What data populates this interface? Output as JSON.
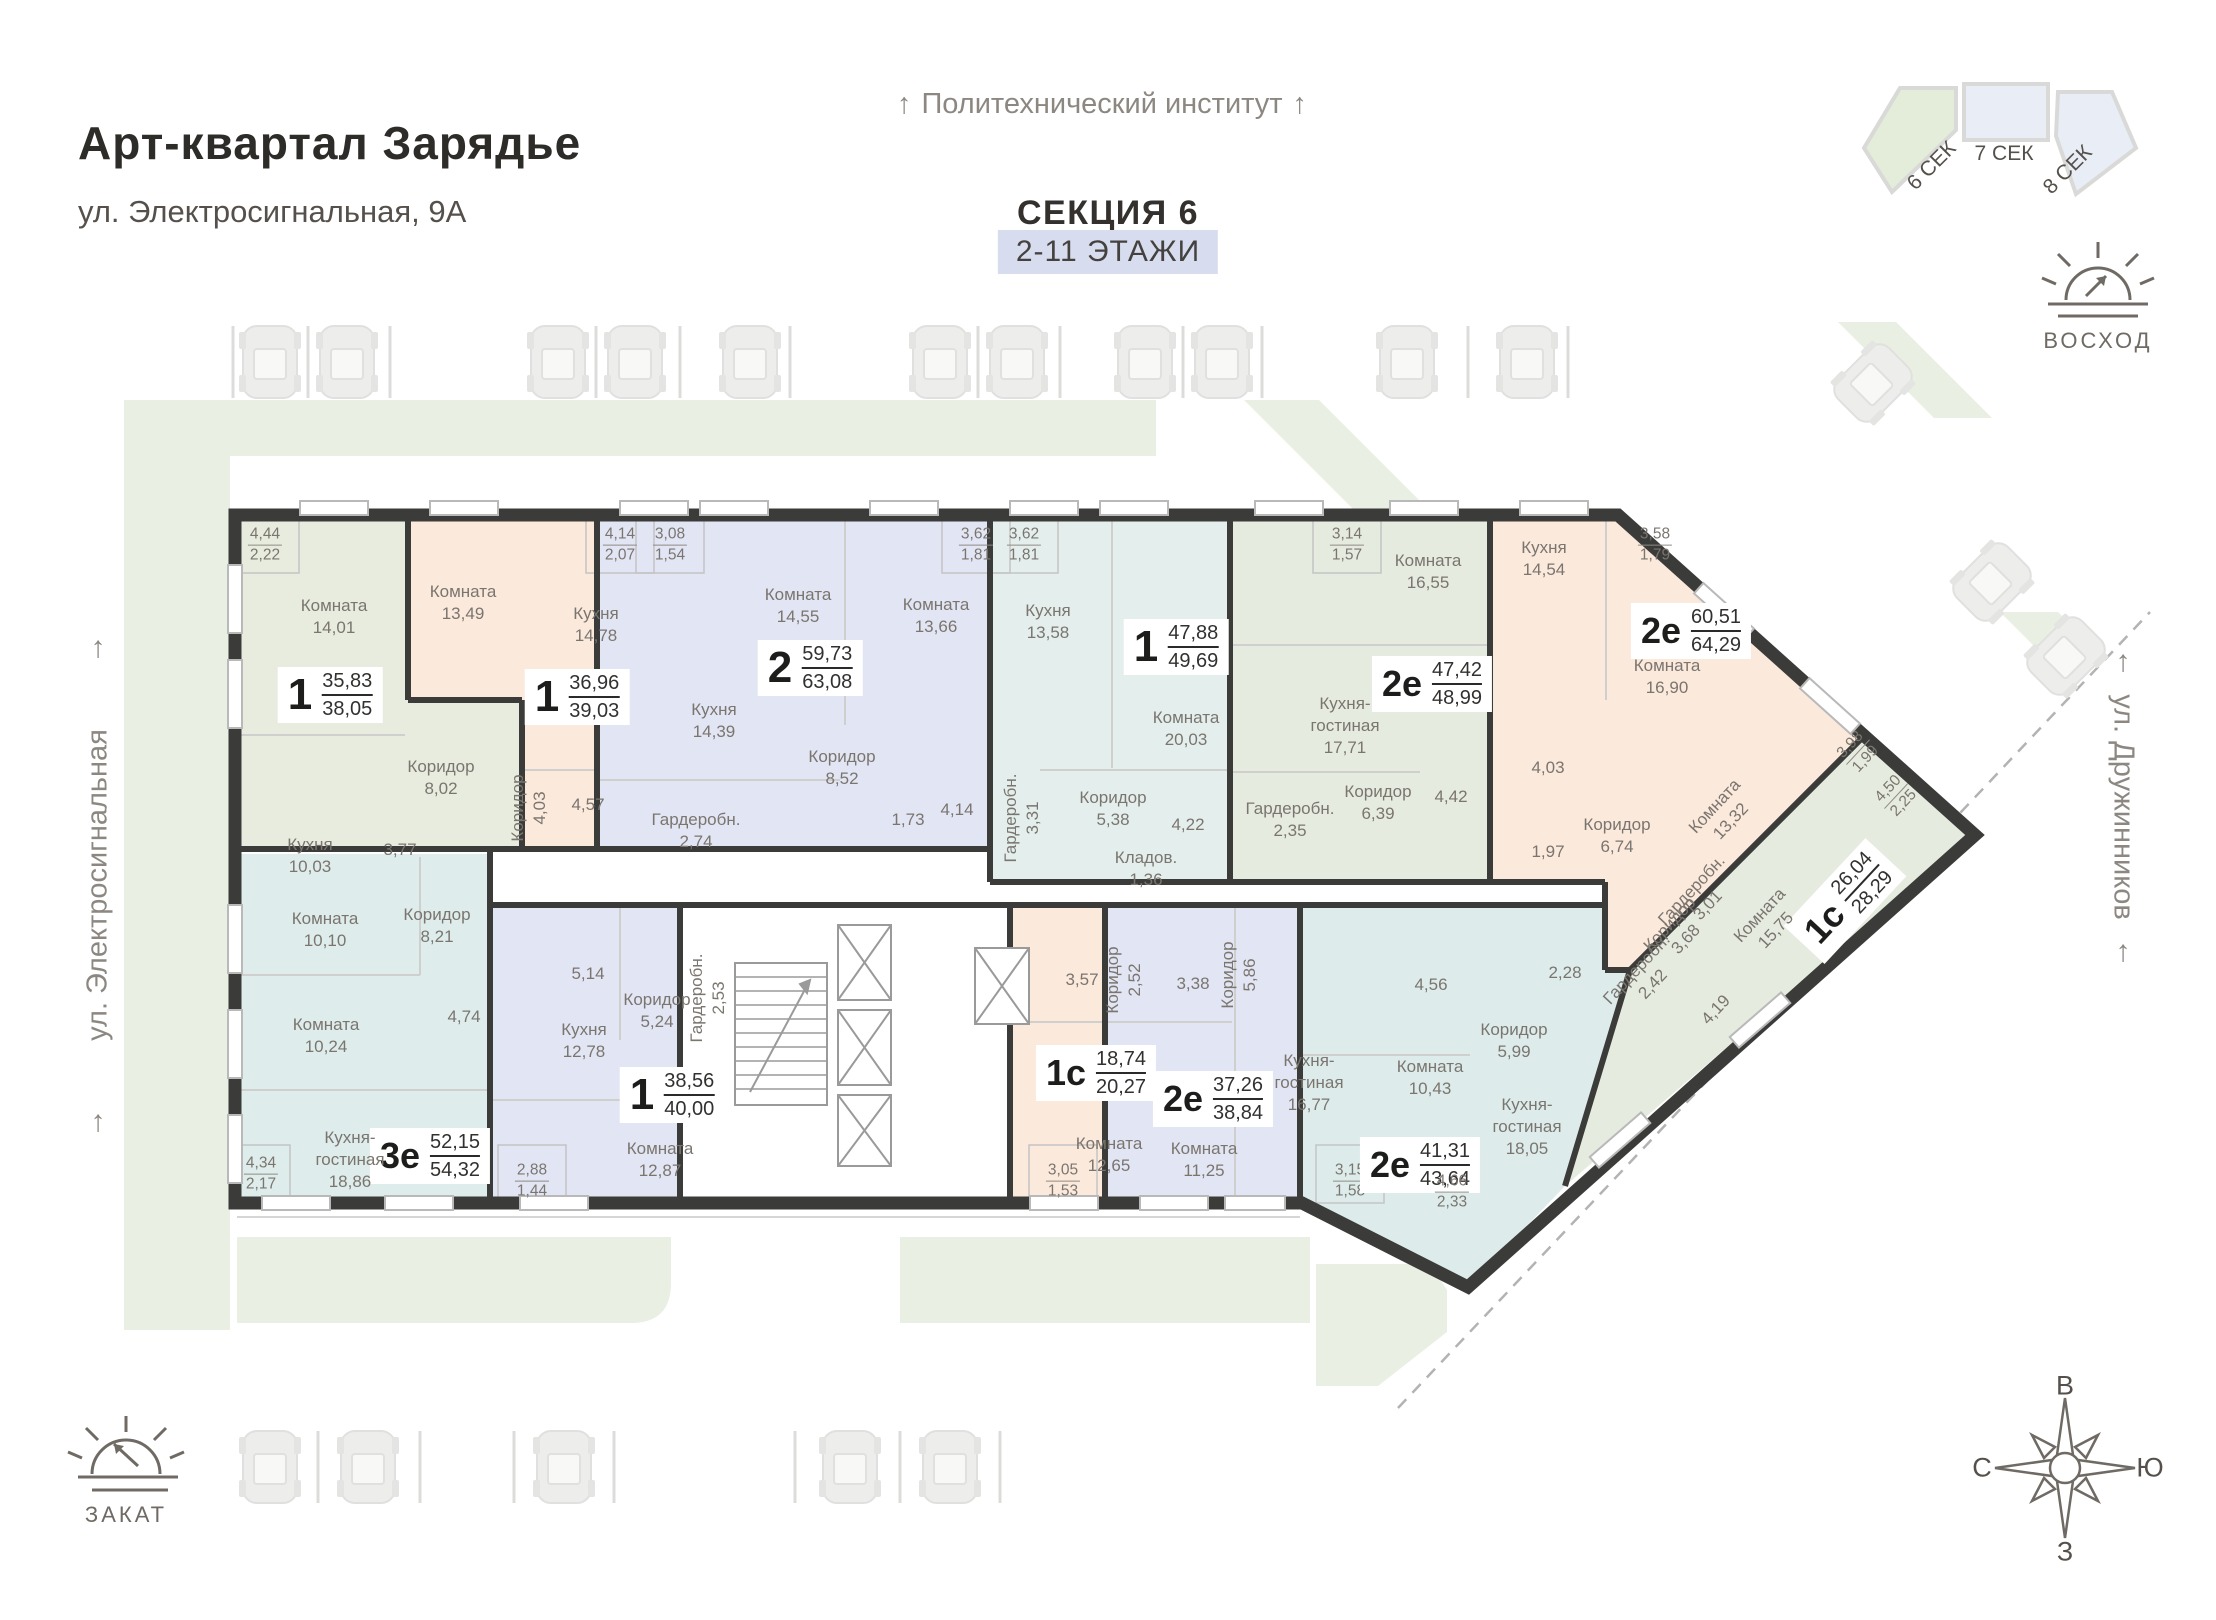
{
  "header": {
    "title": "Арт-квартал  Зарядье",
    "address": "ул. Электросигнальная, 9А"
  },
  "labels": {
    "top_street": "Политехнический институт",
    "section_title": "СЕКЦИЯ 6",
    "floors": "2-11 ЭТАЖИ",
    "left_street": "ул. Электросигнальная",
    "right_street": "ул. Дружинников",
    "sunrise": "ВОСХОД",
    "sunset": "ЗАКАТ"
  },
  "minimap": {
    "sections": [
      "6 СЕК",
      "7 СЕК",
      "8 СЕК"
    ]
  },
  "compass": {
    "top": "В",
    "right": "Ю",
    "bottom": "З",
    "left": "С"
  },
  "colors": {
    "wall": "#3b3b39",
    "green_area": "#e9efe2",
    "floors_badge_bg": "#d7ddef",
    "minimap_green": "#e4ecda",
    "minimap_blue": "#e9edf6"
  },
  "apartments": [
    {
      "id": "a1",
      "type": "1",
      "area_living": "35,83",
      "area_total": "38,05",
      "color": "#e7ecdf",
      "rooms": [
        {
          "name": "Комната",
          "area": "14,01"
        },
        {
          "name": "Кухня",
          "area": "10,03"
        },
        {
          "name": "Коридор",
          "area": "8,02"
        },
        {
          "name": "",
          "area": "3,77"
        }
      ],
      "balconies": [
        {
          "top": "4,44",
          "bottom": "2,22"
        }
      ]
    },
    {
      "id": "a2",
      "type": "1",
      "area_living": "36,96",
      "area_total": "39,03",
      "color": "#fbe9dc",
      "rooms": [
        {
          "name": "Комната",
          "area": "13,49"
        },
        {
          "name": "Кухня",
          "area": "14,78"
        },
        {
          "name": "Коридор",
          "area": "4,03"
        },
        {
          "name": "",
          "area": "4,57"
        }
      ],
      "balconies": [
        {
          "top": "4,14",
          "bottom": "2,07"
        }
      ]
    },
    {
      "id": "a3",
      "type": "2",
      "area_living": "59,73",
      "area_total": "63,08",
      "color": "#e2e5f3",
      "rooms": [
        {
          "name": "Комната",
          "area": "14,55"
        },
        {
          "name": "Комната",
          "area": "13,66"
        },
        {
          "name": "Кухня",
          "area": "14,39"
        },
        {
          "name": "Коридор",
          "area": "8,52"
        },
        {
          "name": "Гардеробн.",
          "area": "2,74"
        },
        {
          "name": "",
          "area": "1,73"
        },
        {
          "name": "",
          "area": "4,14"
        }
      ],
      "balconies": [
        {
          "top": "3,08",
          "bottom": "1,54"
        },
        {
          "top": "3,62",
          "bottom": "1,81"
        }
      ]
    },
    {
      "id": "a4",
      "type": "1",
      "area_living": "47,88",
      "area_total": "49,69",
      "color": "#e4efed",
      "rooms": [
        {
          "name": "Кухня",
          "area": "13,58"
        },
        {
          "name": "Комната",
          "area": "20,03"
        },
        {
          "name": "Коридор",
          "area": "5,38"
        },
        {
          "name": "Кладов.",
          "area": "1,36"
        },
        {
          "name": "Гардеробн.",
          "area": "3,31"
        },
        {
          "name": "",
          "area": "4,22"
        }
      ],
      "balconies": [
        {
          "top": "3,62",
          "bottom": "1,81"
        }
      ]
    },
    {
      "id": "a5",
      "type": "2е",
      "area_living": "47,42",
      "area_total": "48,99",
      "color": "#e6ebe0",
      "rooms": [
        {
          "name": "Комната",
          "area": "16,55"
        },
        {
          "name": "Кухня-\nгостиная",
          "area": "17,71"
        },
        {
          "name": "Коридор",
          "area": "6,39"
        },
        {
          "name": "Гардеробн.",
          "area": "2,35"
        },
        {
          "name": "",
          "area": "4,42"
        }
      ],
      "balconies": [
        {
          "top": "3,14",
          "bottom": "1,57"
        }
      ]
    },
    {
      "id": "a6",
      "type": "2е",
      "area_living": "60,51",
      "area_total": "64,29",
      "color": "#fbe9dc",
      "rooms": [
        {
          "name": "Кухня",
          "area": "14,54"
        },
        {
          "name": "Комната",
          "area": "16,90"
        },
        {
          "name": "Комната",
          "area": "13,32"
        },
        {
          "name": "Коридор",
          "area": "6,74"
        },
        {
          "name": "Гардеробн.",
          "area": "3,01"
        },
        {
          "name": "",
          "area": "4,03"
        },
        {
          "name": "",
          "area": "1,97"
        }
      ],
      "balconies": [
        {
          "top": "3,58",
          "bottom": "1,79"
        },
        {
          "top": "3,98",
          "bottom": "1,99"
        }
      ]
    },
    {
      "id": "a7",
      "type": "1с",
      "area_living": "26,04",
      "area_total": "28,29",
      "color": "#e6ebe0",
      "rooms": [
        {
          "name": "Комната",
          "area": "15,75"
        },
        {
          "name": "Коридор",
          "area": "3,68"
        },
        {
          "name": "Гардеробн.",
          "area": "2,42"
        },
        {
          "name": "",
          "area": "4,19"
        }
      ],
      "balconies": [
        {
          "top": "4,50",
          "bottom": "2,25"
        }
      ]
    },
    {
      "id": "a8",
      "type": "3е",
      "area_living": "52,15",
      "area_total": "54,32",
      "color": "#deeceb",
      "rooms": [
        {
          "name": "Комната",
          "area": "10,10"
        },
        {
          "name": "Комната",
          "area": "10,24"
        },
        {
          "name": "Кухня-\nгостиная",
          "area": "18,86"
        },
        {
          "name": "Коридор",
          "area": "8,21"
        },
        {
          "name": "",
          "area": "4,74"
        }
      ],
      "balconies": [
        {
          "top": "4,34",
          "bottom": "2,17"
        }
      ]
    },
    {
      "id": "a9",
      "type": "1",
      "area_living": "38,56",
      "area_total": "40,00",
      "color": "#e2e5f3",
      "rooms": [
        {
          "name": "Кухня",
          "area": "12,78"
        },
        {
          "name": "Комната",
          "area": "12,87"
        },
        {
          "name": "Коридор",
          "area": "5,24"
        },
        {
          "name": "Гардеробн.",
          "area": "2,53"
        },
        {
          "name": "",
          "area": "5,14"
        }
      ],
      "balconies": [
        {
          "top": "2,88",
          "bottom": "1,44"
        }
      ]
    },
    {
      "id": "a10",
      "type": "1с",
      "area_living": "18,74",
      "area_total": "20,27",
      "color": "#fbe9dc",
      "rooms": [
        {
          "name": "Комната",
          "area": "12,65"
        },
        {
          "name": "Коридор",
          "area": "2,52"
        },
        {
          "name": "",
          "area": "3,57"
        }
      ],
      "balconies": [
        {
          "top": "3,05",
          "bottom": "1,53"
        }
      ]
    },
    {
      "id": "a11",
      "type": "2е",
      "area_living": "37,26",
      "area_total": "38,84",
      "color": "#e2e5f3",
      "rooms": [
        {
          "name": "Кухня-\nгостиная",
          "area": "16,77"
        },
        {
          "name": "Комната",
          "area": "11,25"
        },
        {
          "name": "Коридор",
          "area": "5,86"
        },
        {
          "name": "",
          "area": "3,38"
        }
      ],
      "balconies": [
        {
          "top": "3,15",
          "bottom": "1,58"
        }
      ]
    },
    {
      "id": "a12",
      "type": "2е",
      "area_living": "41,31",
      "area_total": "43,64",
      "color": "#ddeceb",
      "rooms": [
        {
          "name": "Комната",
          "area": "10,43"
        },
        {
          "name": "Кухня-\nгостиная",
          "area": "18,05"
        },
        {
          "name": "Коридор",
          "area": "5,99"
        },
        {
          "name": "",
          "area": "4,56"
        },
        {
          "name": "",
          "area": "2,28"
        }
      ],
      "balconies": [
        {
          "top": "4,66",
          "bottom": "2,33"
        }
      ]
    }
  ]
}
